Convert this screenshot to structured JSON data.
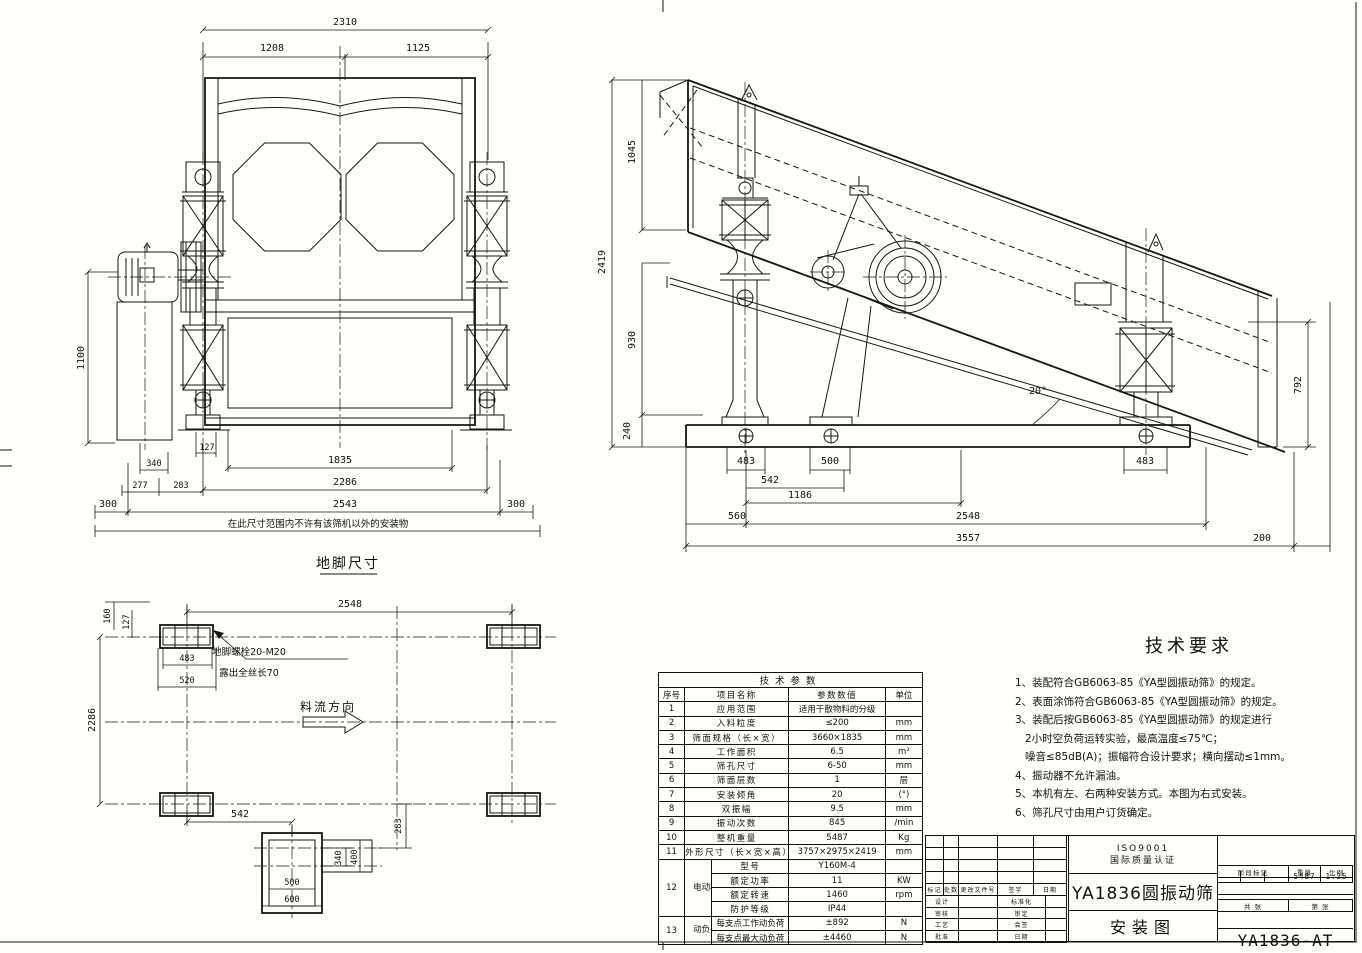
{
  "drawing": {
    "front": {
      "caption": "地脚尺寸",
      "keep_clear_note": "在此尺寸范围内不许有该筛机以外的安装物",
      "dims": {
        "total": "2310",
        "seg_left": "1208",
        "seg_right": "1125",
        "height": "1100",
        "d127": "127",
        "d340": "340",
        "d277": "277",
        "d283": "283",
        "screen_w": "1835",
        "bolt_w": "2286",
        "base_w": "2543",
        "clear_l": "300",
        "clear_r": "300"
      }
    },
    "side": {
      "dims": {
        "total_h": "2419",
        "h_top": "1045",
        "h_mid": "930",
        "h_base": "240",
        "h_end": "792",
        "angle": "20°",
        "foot_l": "483",
        "foot_m": "500",
        "foot_r": "483",
        "s542": "542",
        "s1186": "1186",
        "s560": "560",
        "s2548": "2548",
        "total_len": "3557",
        "s200": "200"
      }
    },
    "plan": {
      "bolt_note_1": "地脚螺栓20-M20",
      "bolt_note_2": "露出全丝长70",
      "flow_label": "料流方向",
      "dims": {
        "span": "2548",
        "d160": "160",
        "d127": "127",
        "d483": "483",
        "d520": "520",
        "side_span": "2286",
        "d542": "542",
        "d283": "283",
        "d340": "340",
        "d400": "400",
        "d500": "500",
        "d600": "600"
      }
    }
  },
  "tech_notes": {
    "title": "技术要求",
    "lines": [
      "1、装配符合GB6063-85《YA型圆振动筛》的规定。",
      "2、表面涂饰符合GB6063-85《YA型圆振动筛》的规定。",
      "3、装配后按GB6063-85《YA型圆振动筛》的规定进行",
      "2小时空负荷运转实验，最高温度≤75℃；",
      "噪音≤85dB(A)；振幅符合设计要求；横向摆动≤1mm。",
      "4、振动器不允许漏油。",
      "5、本机有左、右两种安装方式。本图为右式安装。",
      "6、筛孔尺寸由用户订货确定。"
    ]
  },
  "param_table": {
    "title": "技术参数",
    "headers": {
      "no": "序号",
      "name": "项目名称",
      "value": "参数数值",
      "unit": "单位"
    },
    "rows": [
      {
        "no": "1",
        "name": "应用范围",
        "value": "适用干散物料的分级",
        "unit": ""
      },
      {
        "no": "2",
        "name": "入料粒度",
        "value": "≤200",
        "unit": "mm"
      },
      {
        "no": "3",
        "name": "筛面规格（长×宽）",
        "value": "3660×1835",
        "unit": "mm"
      },
      {
        "no": "4",
        "name": "工作面积",
        "value": "6.5",
        "unit": "m²"
      },
      {
        "no": "5",
        "name": "筛孔尺寸",
        "value": "6-50",
        "unit": "mm"
      },
      {
        "no": "6",
        "name": "筛面层数",
        "value": "1",
        "unit": "层"
      },
      {
        "no": "7",
        "name": "安装倾角",
        "value": "20",
        "unit": "(°)"
      },
      {
        "no": "8",
        "name": "双振幅",
        "value": "9.5",
        "unit": "mm"
      },
      {
        "no": "9",
        "name": "振动次数",
        "value": "845",
        "unit": "/min"
      },
      {
        "no": "10",
        "name": "整机重量",
        "value": "5487",
        "unit": "Kg"
      },
      {
        "no": "11",
        "name": "外形尺寸（长×宽×高）",
        "value": "3757×2975×2419",
        "unit": "mm"
      }
    ],
    "motor": {
      "no": "12",
      "group": "电动机",
      "rows": [
        {
          "name": "型号",
          "value": "Y160M-4",
          "unit": ""
        },
        {
          "name": "额定功率",
          "value": "11",
          "unit": "KW"
        },
        {
          "name": "额定转速",
          "value": "1460",
          "unit": "rpm"
        },
        {
          "name": "防护等级",
          "value": "IP44",
          "unit": ""
        }
      ]
    },
    "load": {
      "no": "13",
      "group": "动负荷",
      "rows": [
        {
          "name": "每支点工作动负荷",
          "value": "±892",
          "unit": "N"
        },
        {
          "name": "每支点最大动负荷",
          "value": "±4460",
          "unit": "N"
        }
      ]
    }
  },
  "title_block": {
    "cert_line_1": "ISO9001",
    "cert_line_2": "国际质量认证",
    "product": "YA1836圆振动筛",
    "sheet_name": "安装图",
    "drawing_no": "YA1836-AT",
    "stage_label": "阶段标记",
    "weight_label": "重量",
    "scale_label": "比例",
    "weight": "5487",
    "scale": "1:25",
    "sheets_total": "共 张",
    "sheet_index": "第 张",
    "rev_headers": [
      "标记",
      "处数",
      "更改文件号",
      "签字",
      "日期"
    ],
    "sign_rows": [
      {
        "l": "设计",
        "r": "标准化"
      },
      {
        "l": "审核",
        "r": "审定"
      },
      {
        "l": "工艺",
        "r": "会签"
      },
      {
        "l": "批准",
        "r": "日期"
      }
    ]
  }
}
